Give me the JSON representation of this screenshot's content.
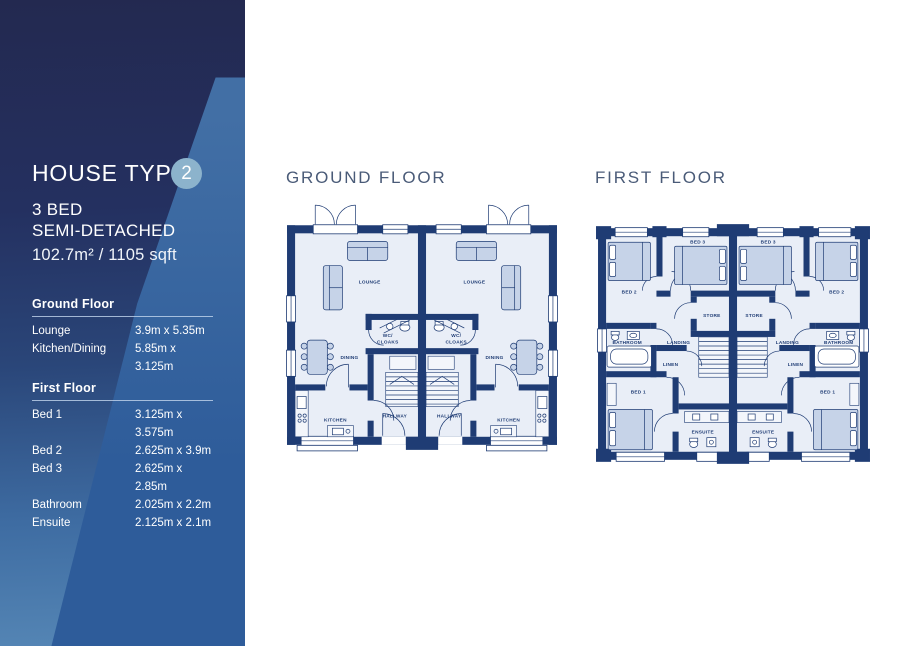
{
  "sidebar": {
    "title": "HOUSE TYPE",
    "badge": "2",
    "type_line1": "3 BED",
    "type_line2": "SEMI-DETACHED",
    "area": "102.7m² / 1105 sqft",
    "sections": {
      "ground": {
        "heading": "Ground Floor",
        "rows": [
          {
            "label": "Lounge",
            "value": "3.9m x 5.35m"
          },
          {
            "label": "Kitchen/Dining",
            "value": "5.85m x 3.125m"
          }
        ]
      },
      "first": {
        "heading": "First Floor",
        "rows": [
          {
            "label": "Bed 1",
            "value": "3.125m x 3.575m"
          },
          {
            "label": "Bed 2",
            "value": "2.625m x 3.9m"
          },
          {
            "label": "Bed 3",
            "value": "2.625m x 2.85m"
          },
          {
            "label": "Bathroom",
            "value": "2.025m x 2.2m"
          },
          {
            "label": "Ensuite",
            "value": "2.125m x 2.1m"
          }
        ]
      }
    }
  },
  "plans": {
    "ground": {
      "title": "GROUND FLOOR"
    },
    "first": {
      "title": "FIRST FLOOR"
    }
  },
  "labels": {
    "ground": {
      "lounge": "LOUNGE",
      "wc_line1": "WC/",
      "wc_line2": "CLOAKS",
      "dining": "DINING",
      "kitchen": "KITCHEN",
      "hallway": "HALLWAY"
    },
    "first": {
      "bed1": "BED 1",
      "bed2": "BED 2",
      "bed3": "BED 3",
      "store": "STORE",
      "bathroom": "BATHROOM",
      "landing": "LANDING",
      "linen": "LINEN",
      "ensuite": "ENSUITE"
    }
  },
  "colors": {
    "sidebar_top": "#232950",
    "sidebar_bottom": "#5586b5",
    "sidebar_band": "#2e5c9a",
    "badge_circle": "#8cb3cc",
    "wall_navy": "#1f3c74",
    "floor_fill": "#e9eef7",
    "furniture_fill": "#c6d3e8",
    "heading_color": "#4a5b78"
  }
}
